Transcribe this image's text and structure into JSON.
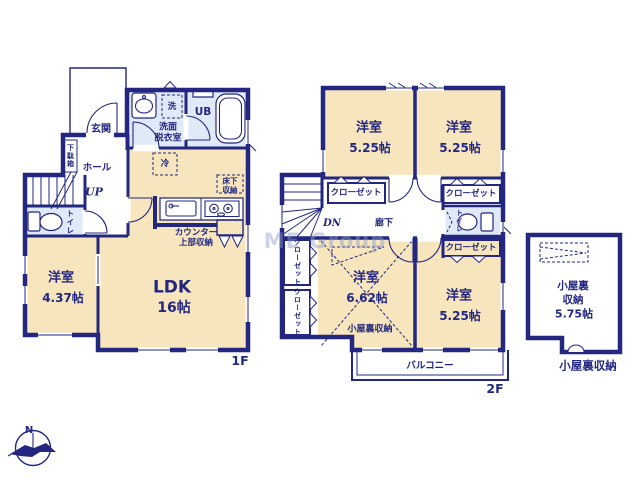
{
  "watermark": "ME Group",
  "colors": {
    "wall_navy": "#232780",
    "room_cream": "#f6e5bd",
    "closet_pink": "#f8d7d9",
    "attic_pink": "#f7dfe7",
    "wet_area_blue": "#dfe9f8"
  },
  "floor1": {
    "label": "1F",
    "entrance": "玄関",
    "shoe_cabinet": "下駄箱",
    "hall": "ホール",
    "stairs_up": "UP",
    "toilet": "トイレ",
    "washroom_line1": "洗面",
    "washroom_line2": "脱衣室",
    "washer": "洗",
    "unit_bath": "UB",
    "fridge": "冷",
    "underfloor_line1": "床下",
    "underfloor_line2": "収納",
    "counter_line1": "カウンター",
    "counter_line2": "上部収納",
    "ldk": {
      "name": "LDK",
      "size": "16帖"
    },
    "bedroom": {
      "name": "洋室",
      "size": "4.37帖"
    }
  },
  "floor2": {
    "label": "2F",
    "stairs_down": "DN",
    "corridor": "廊下",
    "toilet": "トイレ",
    "closet": "クローゼット",
    "balcony": "バルコニー",
    "attic_access_note": "小屋裏収納",
    "rooms": [
      {
        "name": "洋室",
        "size": "5.25帖"
      },
      {
        "name": "洋室",
        "size": "5.25帖"
      },
      {
        "name": "洋室",
        "size": "6.62帖"
      },
      {
        "name": "洋室",
        "size": "5.25帖"
      }
    ]
  },
  "attic": {
    "name_line1": "小屋裏",
    "name_line2": "収納",
    "size": "5.75帖",
    "caption": "小屋裏収納"
  },
  "compass": {
    "north": "N"
  }
}
